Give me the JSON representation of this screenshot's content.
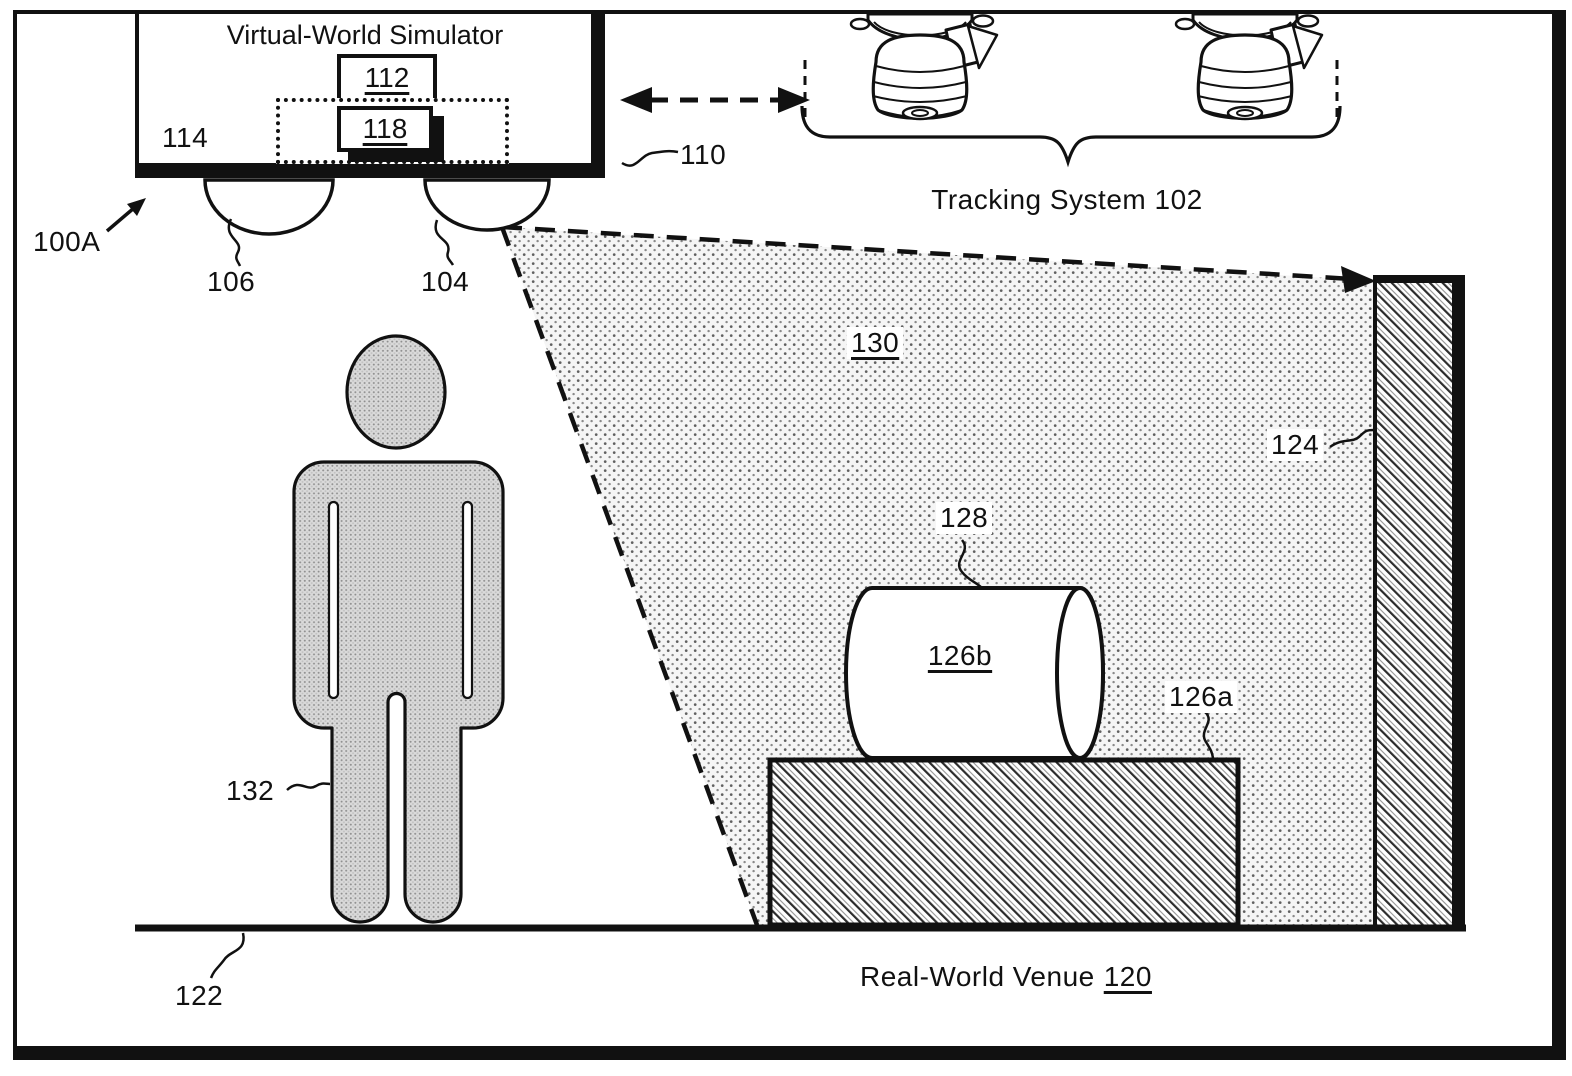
{
  "figure": {
    "ref": "100A"
  },
  "simulator": {
    "title": "Virtual-World Simulator",
    "box112": "112",
    "box118": "118",
    "ref114": "114",
    "ref110": "110",
    "ref106": "106",
    "ref104": "104"
  },
  "tracking": {
    "label": "Tracking System 102"
  },
  "projection": {
    "ref130": "130"
  },
  "venue": {
    "name": "Real-World Venue",
    "ref120": "120",
    "floor_ref122": "122",
    "wall_ref124": "124"
  },
  "props": {
    "ref128": "128",
    "cylinder_ref126b": "126b",
    "pedestal_ref126a": "126a",
    "person_ref132": "132"
  },
  "colors": {
    "ink": "#111111",
    "paper": "#ffffff"
  }
}
